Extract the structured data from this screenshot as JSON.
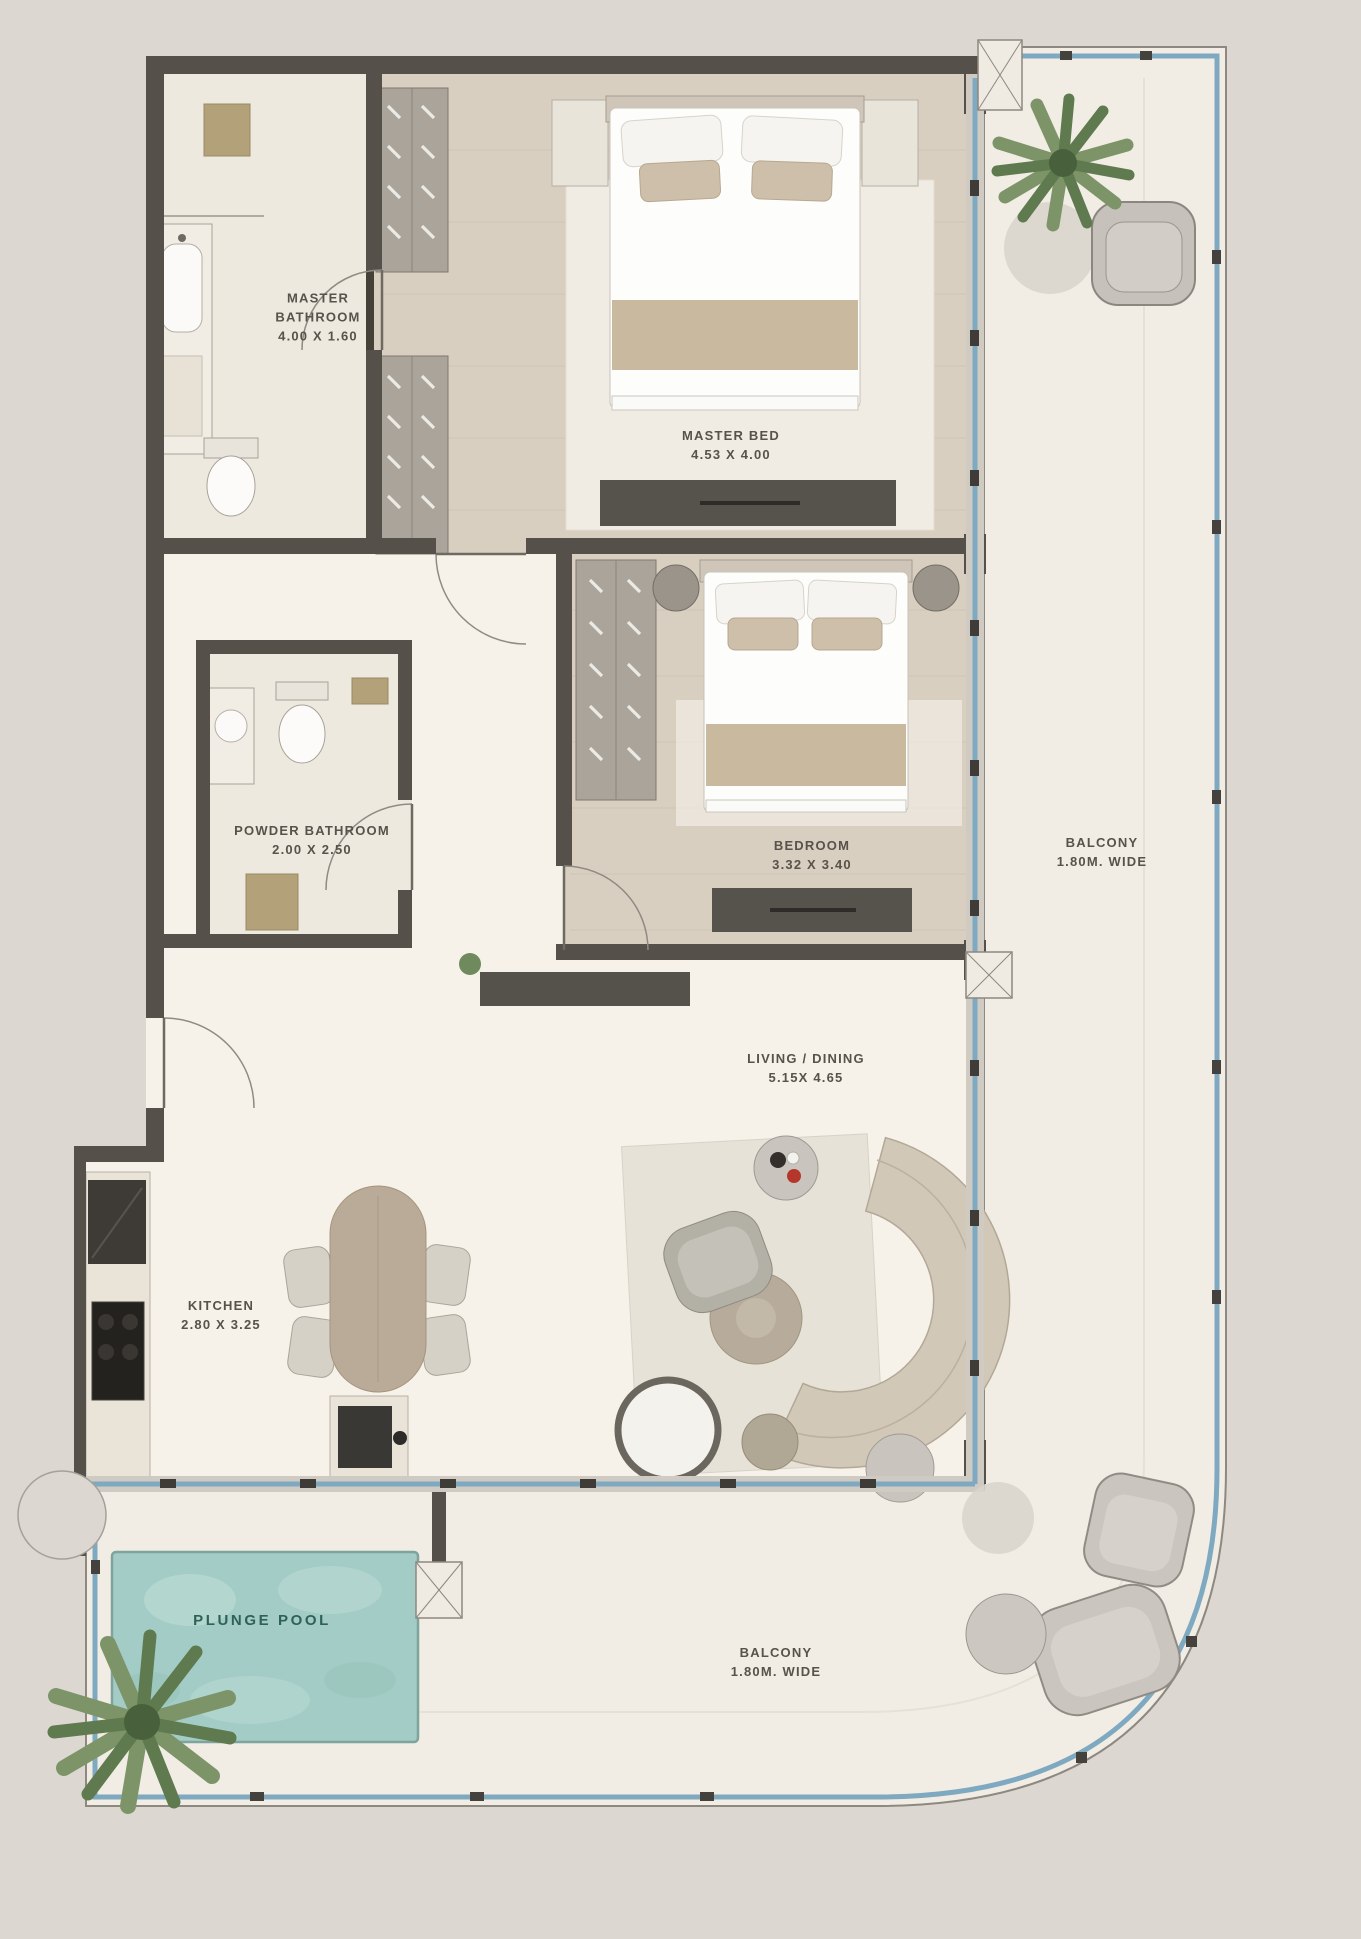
{
  "labels": {
    "master_bathroom": {
      "title": "MASTER BATHROOM",
      "dims": "4.00 X 1.60"
    },
    "master_bed": {
      "title": "MASTER BED",
      "dims": "4.53 X 4.00"
    },
    "powder_bathroom": {
      "title": "POWDER BATHROOM",
      "dims": "2.00 X 2.50"
    },
    "bedroom": {
      "title": "BEDROOM",
      "dims": "3.32 X 3.40"
    },
    "balcony_right": {
      "title": "BALCONY",
      "dims": "1.80M. WIDE"
    },
    "living_dining": {
      "title": "LIVING / DINING",
      "dims": "5.15X 4.65"
    },
    "kitchen": {
      "title": "KITCHEN",
      "dims": "2.80 X 3.25"
    },
    "plunge_pool": {
      "title": "PLUNGE POOL"
    },
    "balcony_bottom": {
      "title": "BALCONY",
      "dims": "1.80M. WIDE"
    }
  },
  "colors": {
    "background": "#dcd8d1",
    "terrace_floor": "#f1ede4",
    "interior_floor": "#f6f2e9",
    "wood_floor": "#d9cfc1",
    "marble_floor": "#eee9df",
    "wall": "#55504a",
    "glass_blue": "#7fa9c0",
    "pool_water": "#a2ccc5",
    "pool_text": "#2f6257",
    "plant_green": "#6f8a5c",
    "gold_accent": "#b3a077",
    "sofa_tan": "#d2c8b8"
  }
}
